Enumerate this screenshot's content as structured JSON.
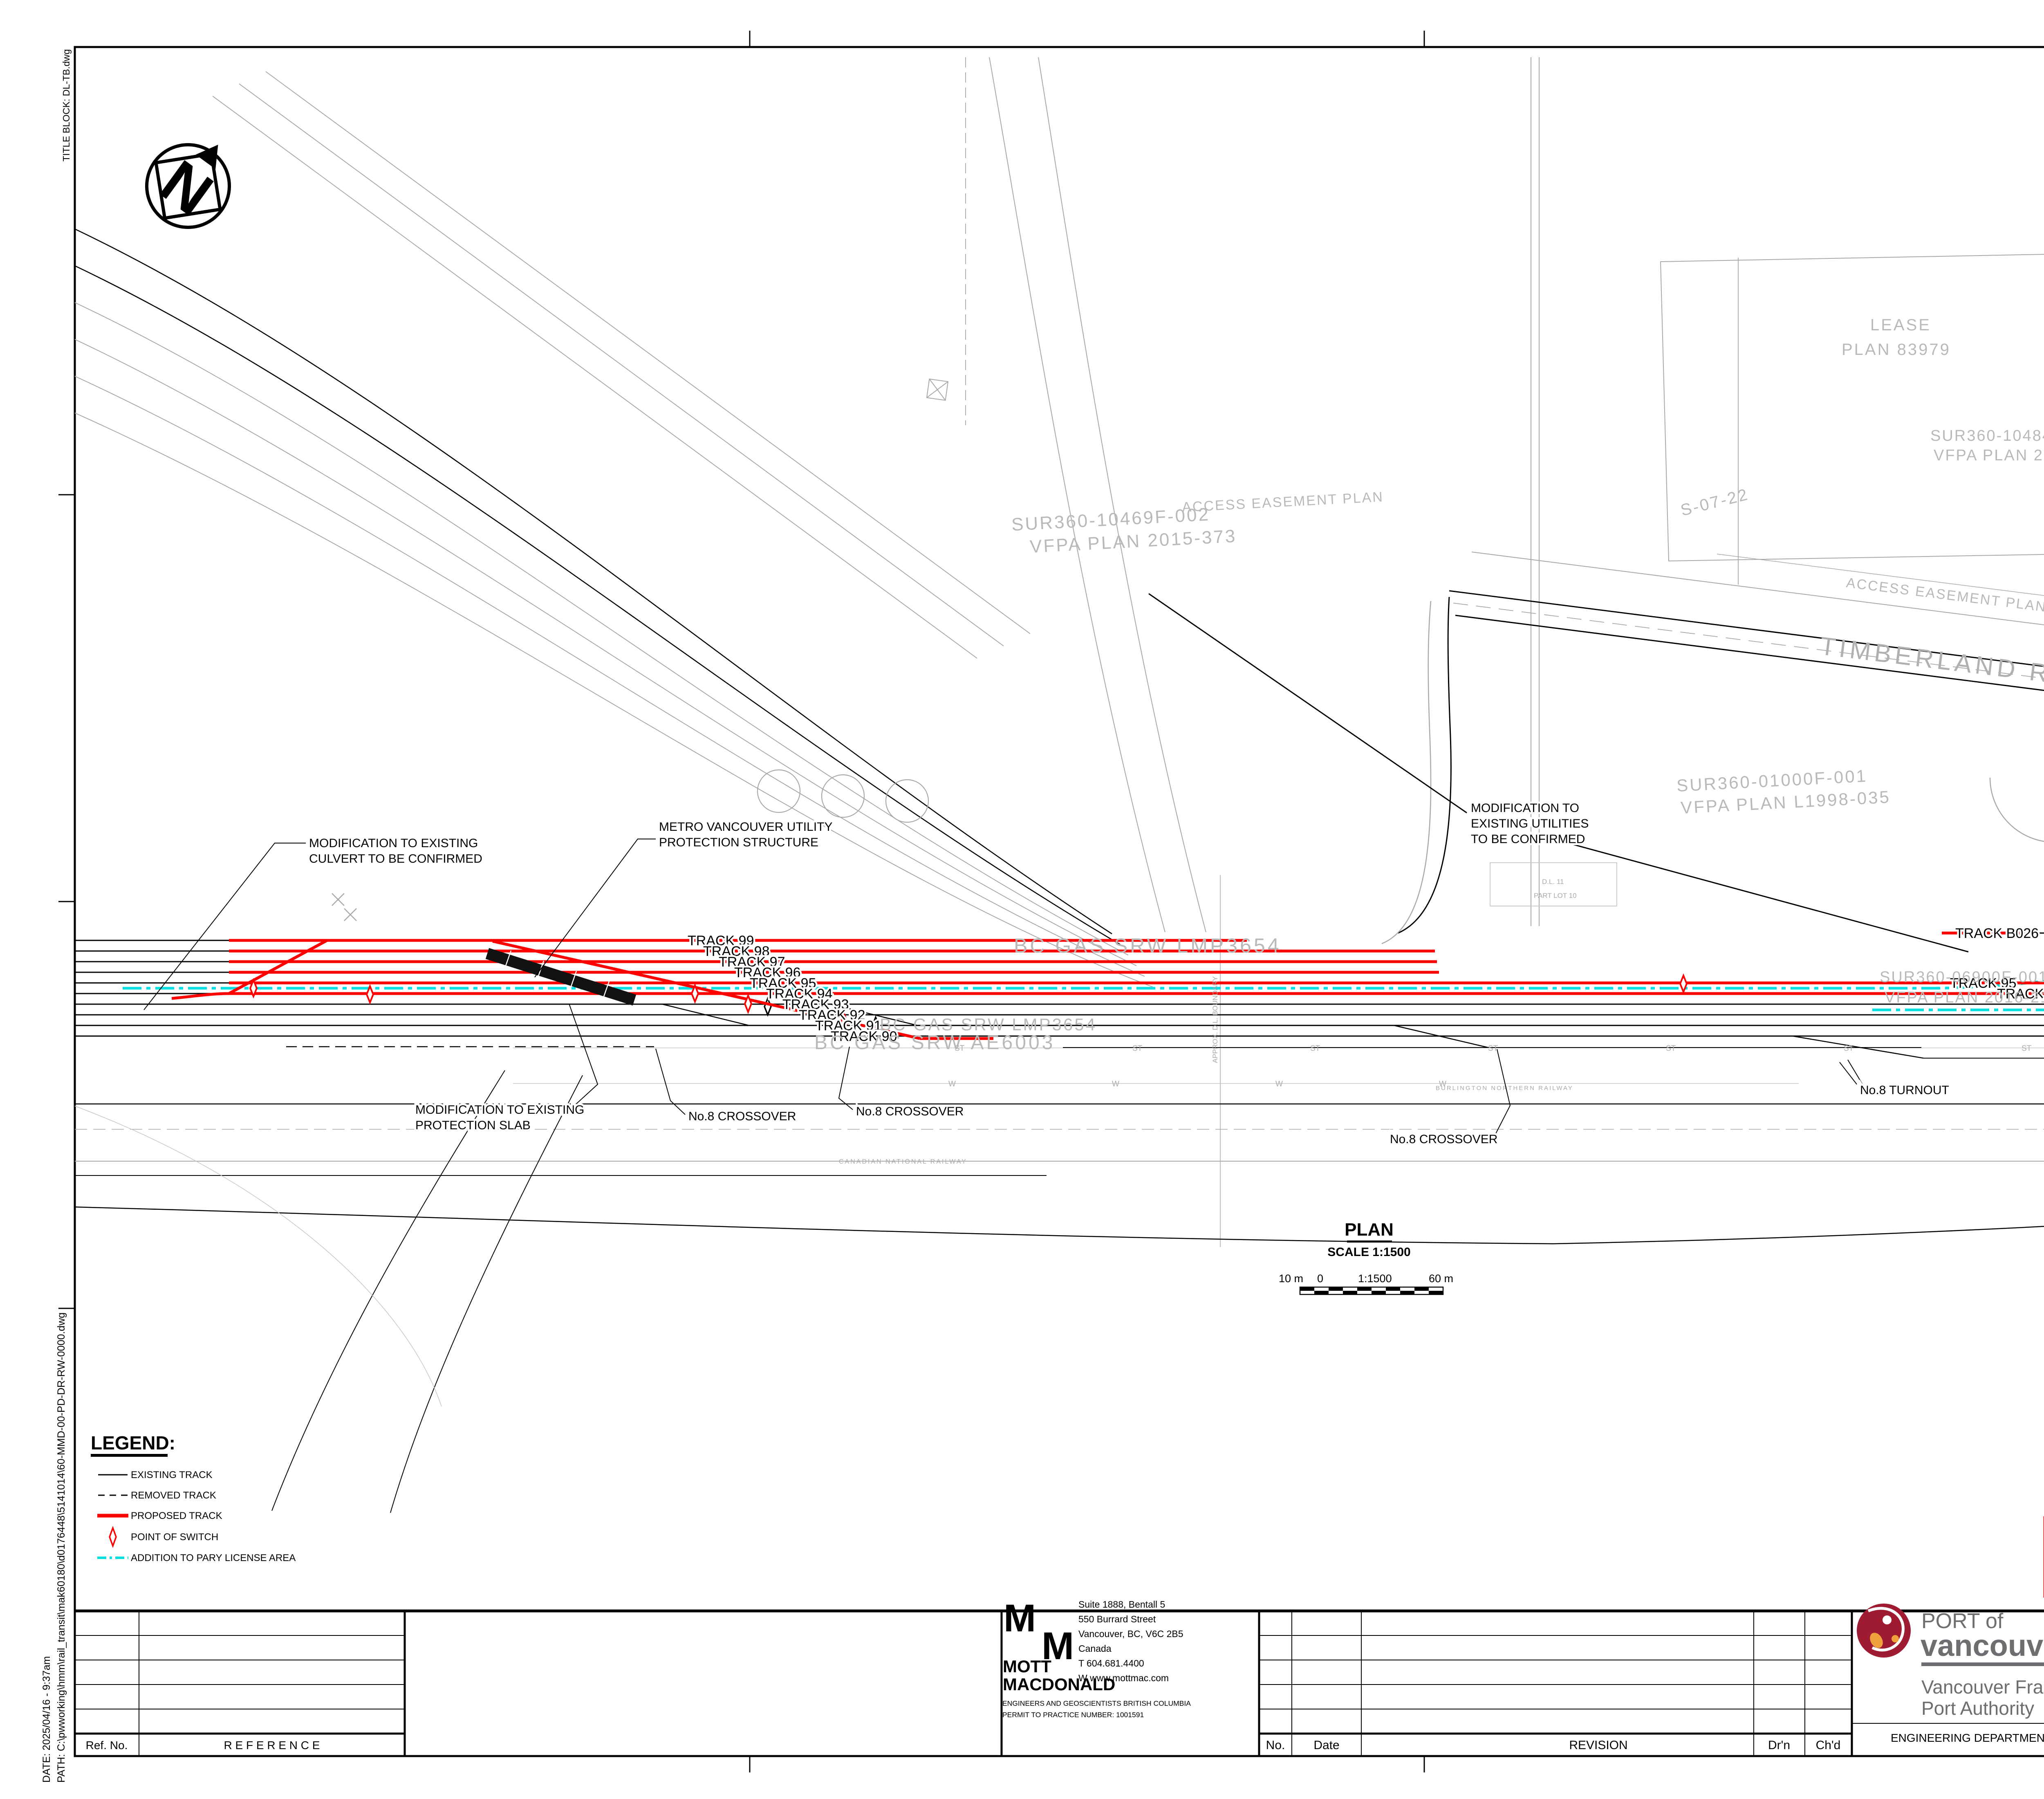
{
  "edge_notes": {
    "title_block": "TITLE BLOCK: DL-TB.dwg",
    "date": "DATE: 2025/04/16 - 9:37am",
    "path": "PATH: C:\\pwworking\\hmm\\rail_transit\\mak60180\\d0176448\\5141014\\60-MMD-00-PD-DR-RW-0000.dwg"
  },
  "plan": {
    "north": "N",
    "title": "PLAN",
    "scale": "SCALE 1:1500",
    "scalebar": {
      "left": "10 m",
      "zero": "0",
      "mid": "1:1500",
      "right": "60 m"
    },
    "road": "TIMBERLAND ROAD",
    "tracks_left": [
      "TRACK 99",
      "TRACK 98",
      "TRACK 97",
      "TRACK 96",
      "TRACK 95",
      "TRACK 94",
      "TRACK 93",
      "TRACK 92",
      "TRACK 91",
      "TRACK 90"
    ],
    "tracks_right": [
      "TRACK B026",
      "TRACK 95",
      "TRACK 94",
      "TRACK 93",
      "TRACK 92",
      "TRACK 91",
      "TRACK 90"
    ],
    "callouts": {
      "culvert1": "MODIFICATION TO EXISTING",
      "culvert2": "CULVERT TO BE CONFIRMED",
      "metro1": "METRO VANCOUVER UTILITY",
      "metro2": "PROTECTION STRUCTURE",
      "utilities1": "MODIFICATION TO",
      "utilities2": "EXISTING UTILITIES",
      "utilities3": "TO BE CONFIRMED",
      "slab1": "MODIFICATION TO EXISTING",
      "slab2": "PROTECTION SLAB",
      "crossover": "No.8 CROSSOVER",
      "turnout8": "No.8 TURNOUT",
      "turnout10": "No.10 TURNOUT"
    },
    "parcels": {
      "bcgas1": "BC GAS SRW LMP3654",
      "bcgas2": "BC GAS SRW AE6003",
      "bcgas3": "BC GAS SRW LMP3654",
      "sur1a": "SUR360-10469F-002",
      "sur1b": "VFPA PLAN 2015-373",
      "access1": "ACCESS EASEMENT PLAN",
      "lease_a": "LEASE",
      "lease_b": "PLAN 83979",
      "sur2a": "SUR360-10484D-001",
      "sur2b": "VFPA PLAN 2015-365",
      "s0722": "S-07-22",
      "sur3a": "SUR360-01000F-001",
      "sur3b": "VFPA PLAN L1998-035",
      "one_a": "1",
      "one_b": "PLAN BCP31356",
      "one_c": "027-132-145",
      "rab_a": "RABANCO LEASE",
      "rab_b": "SUR360-06900F-001",
      "rab_c": "VFPA PLAN 2016-215",
      "sur4a": "SUR360-06900F-001",
      "sur4b": "VFPA PLAN 2016-215",
      "sur5a": "SUR360-00402F-005",
      "sur5b": "VFPA PLAN 2014-269",
      "access2": "ACCESS EASEMENT PLAN LMP39",
      "access3": "ACCESS EASEMENT PLAN 83979",
      "rw": "R/W PLAN"
    },
    "tiny": {
      "st": "ST",
      "w": "W",
      "f": "F",
      "boundary": "APPROX. D.L. BOUNDARY",
      "cn": "CANADIAN NATIONAL RAILWAY",
      "bn": "BURLINGTON NORTHERN RAILWAY",
      "lease_railway": "LEASE-RAILWAY",
      "lease_westran": "LEASE-WESTRAN",
      "dl11a": "D.L. 11",
      "dl11b": "PART LOT 10",
      "dl8a": "D.L. 8",
      "dl8b": "PART LOT 16"
    }
  },
  "legend": {
    "title": "LEGEND:",
    "items": [
      {
        "label": "EXISTING TRACK"
      },
      {
        "label": "REMOVED TRACK"
      },
      {
        "label": "PROPOSED TRACK"
      },
      {
        "label": "POINT OF SWITCH"
      },
      {
        "label": "ADDITION TO PARY LICENSE AREA"
      }
    ]
  },
  "stamps": {
    "permitting": "FOR PERMITTING",
    "construction": "NOT FOR CONSTRUCTION"
  },
  "title_block": {
    "reference": {
      "ref_no": "Ref. No.",
      "reference": "R E F E R E N C E"
    },
    "revision": {
      "no": "No.",
      "date": "Date",
      "revision": "REVISION",
      "drn": "Dr'n",
      "chd": "Ch'd"
    },
    "mott": {
      "m": "M",
      "name1": "MOTT",
      "name2": "MACDONALD",
      "addr1": "Suite 1888, Bentall 5",
      "addr2": "550 Burrard Street",
      "addr3": "Vancouver, BC, V6C 2B5",
      "addr4": "Canada",
      "addr5": "T   604.681.4400",
      "addr6": "W  www.mottmac.com",
      "cert1": "ENGINEERS AND GEOSCIENTISTS BRITISH COLUMBIA",
      "cert2": "PERMIT TO PRACTICE NUMBER: 1001591"
    },
    "pov": {
      "port_of": "PORT of",
      "vancouver": "vancouver",
      "org1": "Vancouver Fraser",
      "org2": "Port Authority",
      "dept": "ENGINEERING DEPARTMENT"
    },
    "fields": [
      {
        "label": "DESIGN BY",
        "value": "N.SITU"
      },
      {
        "label": "DRAWN BY",
        "value": "N.SITU"
      },
      {
        "label": "APPROVED",
        "value": "S.RIDDICK"
      },
      {
        "label": "DATE",
        "value": "2025-02-20"
      },
      {
        "label": "SCALE",
        "value": "AS SHOWN"
      },
      {
        "label": "VFPA SITE",
        "value": "24"
      }
    ],
    "title_lines": [
      "VANCOUVER FRASER PORT AUTHORITY",
      "PARY RAIL EXPANSION PROJECT",
      "SITE PLAN",
      "PROPOSED CONDITIONS"
    ],
    "size": {
      "label": "SIZE",
      "value": "D"
    },
    "dwg": {
      "label": "DWG.",
      "value": "24-019-GA-003"
    },
    "sheet": {
      "label": "SHEET",
      "value": "2 of 3"
    },
    "rev": {
      "label": "REV.",
      "value": "B"
    }
  },
  "colors": {
    "proposed_track": "#ff0000",
    "license_area": "#00e0e0",
    "stamp_red": "#ed1c24",
    "pov_red": "#9e1b32",
    "pov_orange": "#f0a23c",
    "pov_gray": "#6d6e71"
  }
}
